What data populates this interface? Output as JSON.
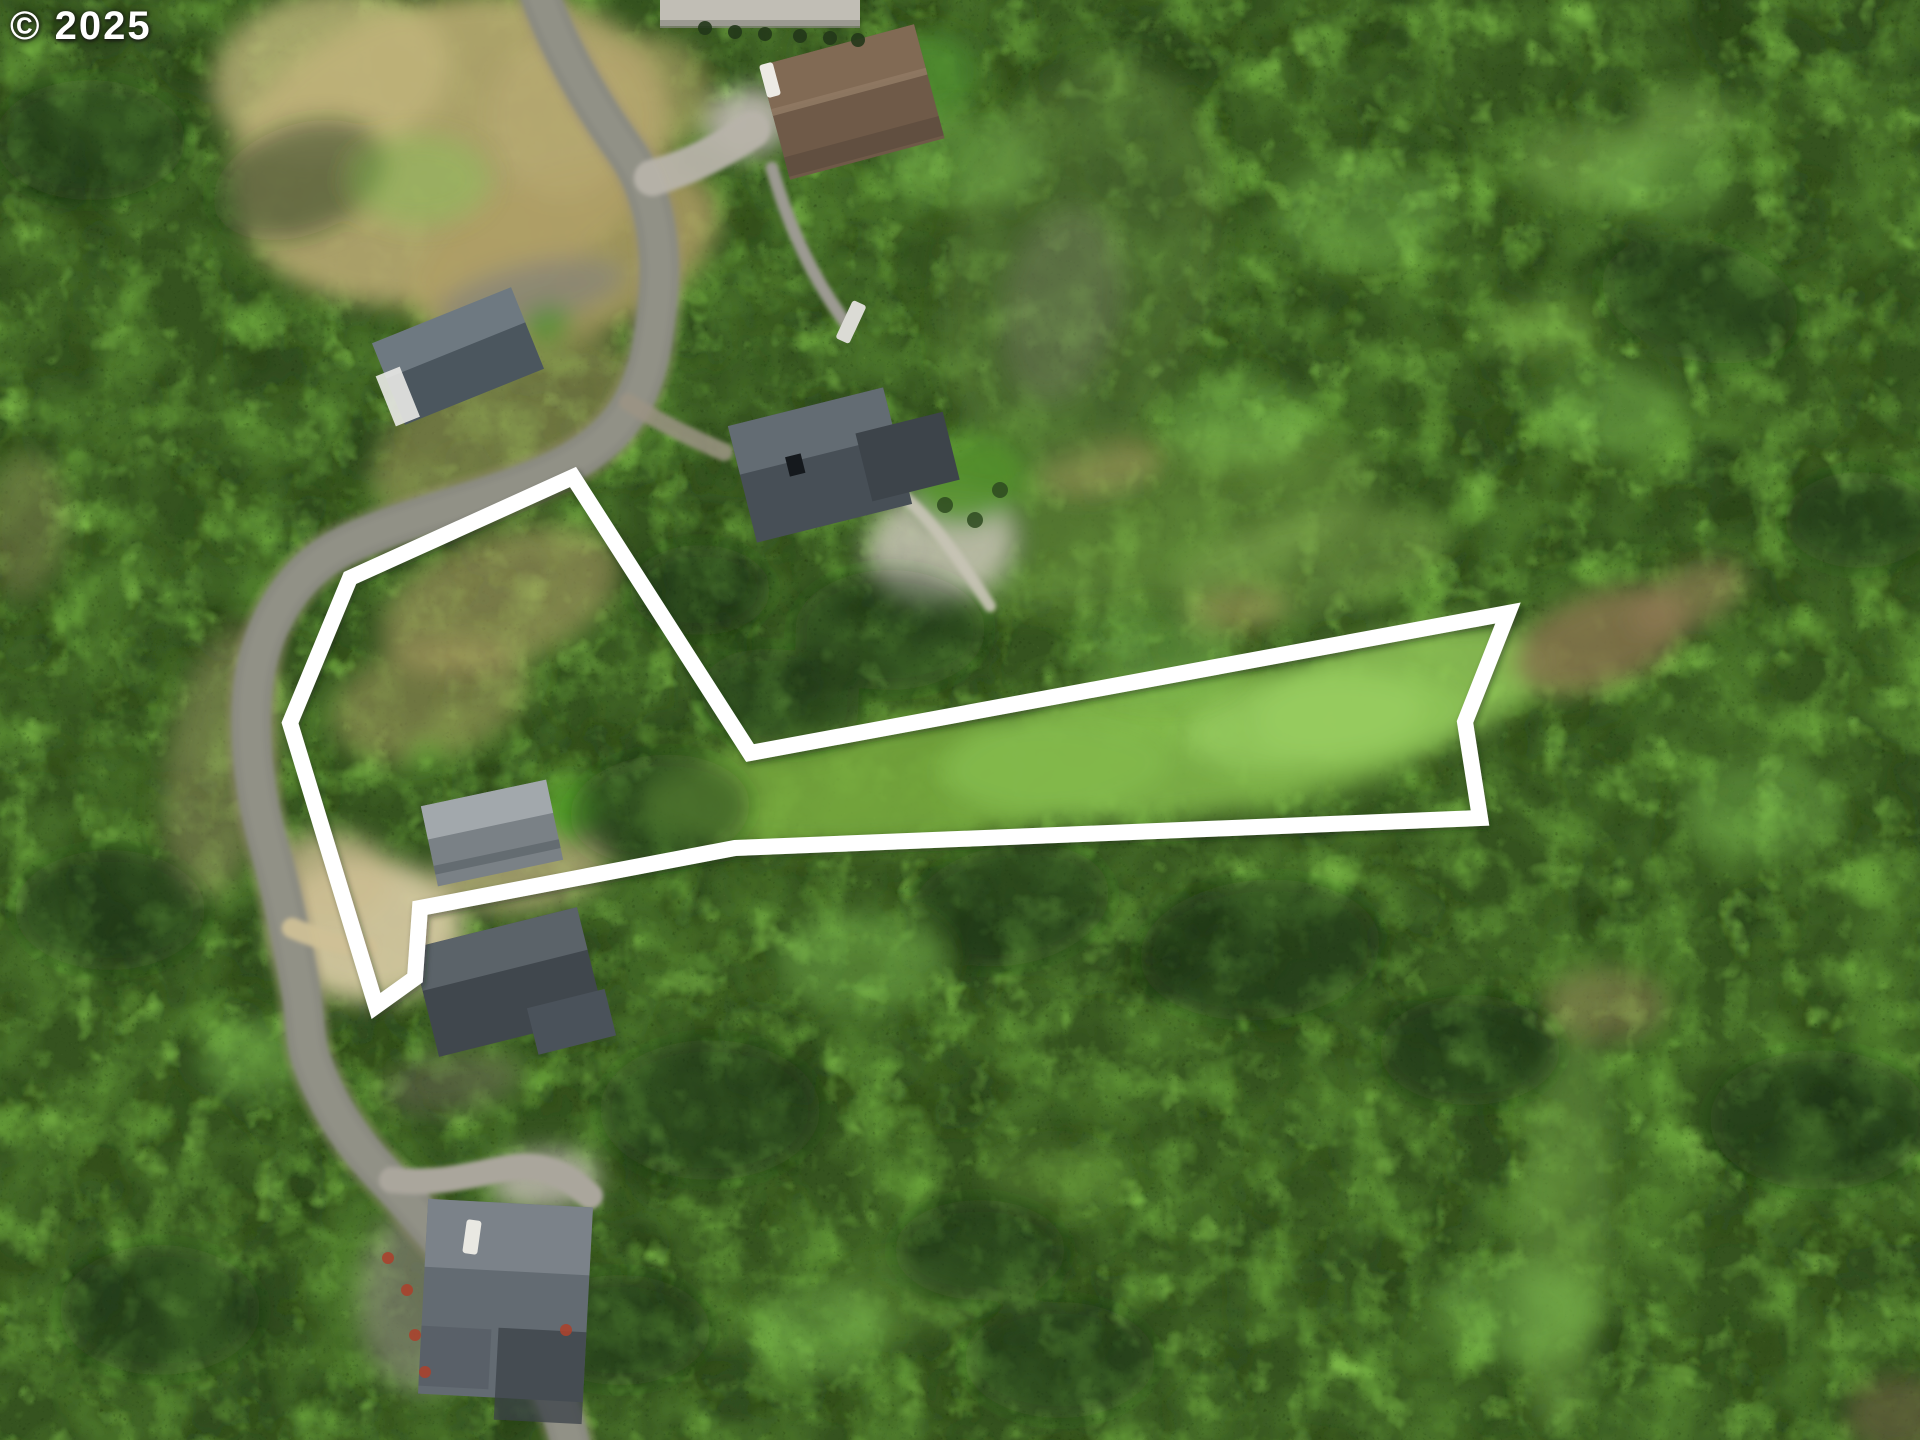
{
  "watermark": {
    "text": "© 2025",
    "color": "#ffffff"
  },
  "canvas": {
    "width": 1920,
    "height": 1440
  },
  "boundary": {
    "color": "#ffffff",
    "stroke_width": 16,
    "points": [
      [
        573,
        477
      ],
      [
        750,
        753
      ],
      [
        1508,
        613
      ],
      [
        1465,
        722
      ],
      [
        1480,
        818
      ],
      [
        735,
        848
      ],
      [
        420,
        908
      ],
      [
        415,
        978
      ],
      [
        376,
        1006
      ],
      [
        290,
        723
      ],
      [
        350,
        578
      ]
    ]
  },
  "texture_layers": [
    {
      "fill": "#35531f",
      "filter": "",
      "opacity": 1
    },
    {
      "fill": "#263f16",
      "filter": "nDark",
      "opacity": 1
    },
    {
      "fill": "#4e7a2c",
      "filter": "nMid",
      "opacity": 1
    },
    {
      "fill": "#659d38",
      "filter": "nLight",
      "opacity": 1
    },
    {
      "fill": "#7fbc49",
      "filter": "nLight2",
      "opacity": 0.9
    },
    {
      "fill": "#0d1807",
      "filter": "nSpeckD",
      "opacity": 0.32
    },
    {
      "fill": "#b4dc82",
      "filter": "nSpeckL",
      "opacity": 0.15
    }
  ],
  "patches": [
    [
      450,
      150,
      225,
      150,
      -15,
      "#b7a871",
      0.9
    ],
    [
      330,
      75,
      120,
      85,
      -10,
      "#c3b67e",
      0.75
    ],
    [
      565,
      255,
      160,
      85,
      -20,
      "#ae9e65",
      0.85
    ],
    [
      648,
      95,
      65,
      60,
      0,
      "#b3a26b",
      0.6
    ],
    [
      560,
      120,
      70,
      80,
      -10,
      "#b9aa73",
      0.6
    ],
    [
      505,
      430,
      145,
      75,
      -28,
      "#a89a62",
      0.5
    ],
    [
      500,
      600,
      125,
      65,
      -20,
      "#b2a069",
      0.55
    ],
    [
      430,
      700,
      100,
      58,
      -15,
      "#aa9961",
      0.5
    ],
    [
      368,
      930,
      95,
      72,
      0,
      "#d3c69f",
      0.95
    ],
    [
      330,
      878,
      62,
      46,
      0,
      "#cabb90",
      0.8
    ],
    [
      525,
      868,
      88,
      42,
      -10,
      "#c2b183",
      0.7
    ],
    [
      905,
      782,
      265,
      62,
      -5,
      "#79ad41",
      0.85
    ],
    [
      1205,
      742,
      265,
      72,
      -7,
      "#86bc4e",
      0.85
    ],
    [
      1400,
      692,
      150,
      62,
      -14,
      "#90c558",
      0.85
    ],
    [
      1305,
      722,
      120,
      45,
      -8,
      "#9cd065",
      0.6
    ],
    [
      1150,
      520,
      230,
      82,
      -12,
      "#6f9a44",
      0.5
    ],
    [
      1310,
      565,
      140,
      52,
      -12,
      "#7da24b",
      0.5
    ],
    [
      1100,
      468,
      62,
      26,
      -10,
      "#a5975f",
      0.55
    ],
    [
      1235,
      612,
      52,
      23,
      -10,
      "#9f8d57",
      0.5
    ],
    [
      1600,
      640,
      92,
      46,
      -20,
      "#86744e",
      0.85
    ],
    [
      1688,
      598,
      62,
      30,
      -25,
      "#907d54",
      0.65
    ],
    [
      1080,
      265,
      135,
      215,
      15,
      "#5c7a3a",
      0.45
    ],
    [
      1062,
      305,
      58,
      98,
      12,
      "#7d7f6f",
      0.35
    ],
    [
      1592,
      162,
      72,
      40,
      0,
      "#7fae4e",
      0.5
    ],
    [
      1682,
      120,
      52,
      30,
      0,
      "#88b656",
      0.45
    ],
    [
      1545,
      330,
      60,
      35,
      0,
      "#76a548",
      0.45
    ],
    [
      1565,
      1230,
      48,
      205,
      3,
      "#6f9d42",
      0.55
    ],
    [
      1605,
      1005,
      62,
      36,
      0,
      "#9b8a5c",
      0.5
    ],
    [
      905,
      1300,
      82,
      40,
      0,
      "#5d8836",
      0.4
    ],
    [
      1055,
      1180,
      72,
      36,
      0,
      "#648f3a",
      0.4
    ],
    [
      222,
      762,
      55,
      140,
      10,
      "#9f9468",
      0.45
    ],
    [
      532,
      294,
      96,
      30,
      -13,
      "#8c8775",
      0.9
    ],
    [
      940,
      545,
      75,
      58,
      -15,
      "#c6c2b4",
      0.85
    ],
    [
      968,
      480,
      60,
      45,
      -15,
      "#55922e",
      0.9
    ],
    [
      922,
      78,
      56,
      45,
      -15,
      "#4f8d2e",
      0.8
    ],
    [
      570,
      812,
      30,
      32,
      0,
      "#58a12c",
      0.95
    ],
    [
      426,
      752,
      17,
      9,
      -10,
      "#5da630",
      0.9
    ],
    [
      547,
      326,
      26,
      19,
      -20,
      "#4f8d2e",
      0.8
    ],
    [
      452,
      1082,
      70,
      30,
      -8,
      "#6b6557",
      0.5
    ],
    [
      420,
      1300,
      62,
      92,
      0,
      "#8f8b80",
      0.6
    ],
    [
      25,
      525,
      42,
      72,
      5,
      "#8d8058",
      0.4
    ],
    [
      1900,
      1415,
      55,
      40,
      0,
      "#6b5a40",
      0.6
    ],
    [
      748,
      122,
      42,
      34,
      -15,
      "#bab6ac",
      0.95
    ],
    [
      545,
      1180,
      55,
      30,
      -5,
      "#b1ada3",
      0.9
    ]
  ],
  "roads": [
    {
      "d": "M535,-20 C552,35 585,95 625,150 C655,192 663,250 658,300 C653,352 645,395 615,428 C585,461 540,480 478,499 C420,517 380,528 342,547 C300,568 268,612 256,668 C247,712 250,780 270,850 C282,892 292,940 300,985 C306,1018 304,1040 312,1062 C325,1098 345,1135 385,1177 C425,1219 468,1272 508,1320 C540,1360 560,1400 570,1442",
      "color": "#9a9074",
      "width": 52,
      "opacity": 0.3
    },
    {
      "d": "M535,-20 C552,35 585,95 625,150 C655,192 663,250 658,300 C653,352 645,395 615,428 C585,461 540,480 478,499 C420,517 380,528 342,547 C300,568 268,612 256,668 C247,712 250,780 270,850 C282,892 292,940 300,985 C306,1018 304,1040 312,1062 C325,1098 345,1135 385,1177 C425,1219 468,1272 508,1320 C540,1360 560,1400 570,1442",
      "color": "#8b8b81",
      "width": 40,
      "opacity": 1
    },
    {
      "d": "M535,-20 C552,35 585,95 625,150 C655,192 663,250 658,300 C653,352 645,395 615,428 C585,461 540,480 478,499 C420,517 380,528 342,547 C300,568 268,612 256,668 C247,712 250,780 270,850 C282,892 292,940 300,985 C306,1018 304,1040 312,1062 C325,1098 345,1135 385,1177 C425,1219 468,1272 508,1320 C540,1360 560,1400 570,1442",
      "color": "#9a998b",
      "width": 24,
      "opacity": 0.45
    },
    {
      "d": "M652,178 C688,168 720,152 752,130",
      "color": "#b7b3a9",
      "width": 36,
      "opacity": 0.95
    },
    {
      "d": "M772,168 C788,225 812,278 848,326",
      "color": "#9c9a92",
      "width": 13,
      "opacity": 1
    },
    {
      "d": "M392,1180 C450,1186 480,1170 520,1167 C550,1165 572,1180 590,1196",
      "color": "#aaa69c",
      "width": 26,
      "opacity": 1
    },
    {
      "d": "M292,928 C320,940 345,946 368,947",
      "color": "#cfc096",
      "width": 20,
      "opacity": 0.95
    },
    {
      "d": "M628,402 C662,424 692,438 724,452",
      "color": "#9b9384",
      "width": 18,
      "opacity": 0.85
    },
    {
      "d": "M880,480 C920,500 960,560 990,606",
      "color": "#c8c4b6",
      "width": 12,
      "opacity": 0.9
    }
  ],
  "houses": [
    {
      "name": "house-top-left",
      "cx": 458,
      "cy": 356,
      "rot": -22,
      "parts": [
        {
          "x": -75,
          "y": -44,
          "w": 150,
          "h": 88,
          "fill": "#4b565e",
          "op": 1
        },
        {
          "x": -75,
          "y": -44,
          "w": 150,
          "h": 38,
          "fill": "#747f87",
          "op": 0.85
        },
        {
          "x": -84,
          "y": -12,
          "w": 26,
          "h": 54,
          "fill": "#e9e9e5",
          "op": 0.9
        }
      ]
    },
    {
      "name": "house-top-center-brown",
      "cx": 852,
      "cy": 102,
      "rot": -15,
      "parts": [
        {
          "x": -80,
          "y": -59,
          "w": 160,
          "h": 118,
          "fill": "#6f5a48",
          "op": 1
        },
        {
          "x": -80,
          "y": -59,
          "w": 160,
          "h": 48,
          "fill": "#836b55",
          "op": 0.9
        },
        {
          "x": -80,
          "y": -14,
          "w": 160,
          "h": 7,
          "fill": "#8f7963",
          "op": 0.9
        },
        {
          "x": -80,
          "y": 36,
          "w": 160,
          "h": 20,
          "fill": "#5e4c3e",
          "op": 0.8
        }
      ]
    },
    {
      "name": "house-mid-right",
      "cx": 820,
      "cy": 465,
      "rot": -14,
      "parts": [
        {
          "x": -80,
          "y": -60,
          "w": 160,
          "h": 120,
          "fill": "#474f56",
          "op": 1
        },
        {
          "x": -80,
          "y": -60,
          "w": 160,
          "h": 50,
          "fill": "#6a737a",
          "op": 0.8
        },
        {
          "x": 42,
          "y": -22,
          "w": 90,
          "h": 70,
          "fill": "#3d444a",
          "op": 1
        },
        {
          "x": -32,
          "y": -16,
          "w": 16,
          "h": 20,
          "fill": "#15191d",
          "op": 1
        }
      ]
    },
    {
      "name": "house-inside-lot",
      "cx": 492,
      "cy": 833,
      "rot": -12,
      "parts": [
        {
          "x": -64,
          "y": -41,
          "w": 128,
          "h": 82,
          "fill": "#7a8186",
          "op": 1
        },
        {
          "x": -64,
          "y": -41,
          "w": 128,
          "h": 34,
          "fill": "#a6acb0",
          "op": 0.9
        },
        {
          "x": -64,
          "y": 20,
          "w": 128,
          "h": 9,
          "fill": "#5f666b",
          "op": 0.8
        }
      ]
    },
    {
      "name": "house-below-lot",
      "cx": 508,
      "cy": 982,
      "rot": -14,
      "parts": [
        {
          "x": -85,
          "y": -56,
          "w": 170,
          "h": 112,
          "fill": "#40474d",
          "op": 1
        },
        {
          "x": -85,
          "y": -56,
          "w": 170,
          "h": 44,
          "fill": "#60686f",
          "op": 0.85
        },
        {
          "x": 12,
          "y": 30,
          "w": 80,
          "h": 48,
          "fill": "#4a525a",
          "op": 1
        }
      ]
    },
    {
      "name": "house-bottom",
      "cx": 505,
      "cy": 1300,
      "rot": 3,
      "parts": [
        {
          "x": -82,
          "y": -97,
          "w": 165,
          "h": 195,
          "fill": "#636b72",
          "op": 1
        },
        {
          "x": -82,
          "y": -97,
          "w": 165,
          "h": 68,
          "fill": "#7d858c",
          "op": 0.9
        },
        {
          "x": -5,
          "y": 28,
          "w": 88,
          "h": 92,
          "fill": "#3b4248",
          "op": 0.75
        },
        {
          "x": -82,
          "y": 30,
          "w": 70,
          "h": 60,
          "fill": "#565e65",
          "op": 0.8
        }
      ]
    },
    {
      "name": "building-top-edge",
      "cx": 760,
      "cy": 12,
      "rot": 0,
      "parts": [
        {
          "x": -100,
          "y": -14,
          "w": 200,
          "h": 28,
          "fill": "#c1beb5",
          "op": 1
        },
        {
          "x": -100,
          "y": 8,
          "w": 200,
          "h": 8,
          "fill": "#8a8a82",
          "op": 0.7
        }
      ]
    }
  ],
  "details": {
    "cars": [
      {
        "x": 770,
        "y": 80,
        "rot": -15,
        "w": 14,
        "h": 34,
        "fill": "#eceae4"
      },
      {
        "x": 472,
        "y": 1237,
        "rot": 8,
        "w": 15,
        "h": 34,
        "fill": "#e9e8e2"
      },
      {
        "x": 851,
        "y": 322,
        "rot": 25,
        "w": 15,
        "h": 42,
        "fill": "#dbdbd5"
      }
    ],
    "red_shrubs": [
      [
        407,
        1290
      ],
      [
        415,
        1335
      ],
      [
        425,
        1372
      ],
      [
        566,
        1330
      ],
      [
        388,
        1258
      ]
    ],
    "red_shrub_color": "#a8432e",
    "hedges": [
      [
        705,
        28
      ],
      [
        735,
        32
      ],
      [
        765,
        34
      ],
      [
        800,
        36
      ],
      [
        830,
        38
      ],
      [
        858,
        40
      ]
    ],
    "hedge_color": "#22371a",
    "garden_bushes": [
      [
        945,
        505
      ],
      [
        975,
        520
      ],
      [
        1000,
        490
      ]
    ],
    "garden_bush_color": "#2e4a20",
    "canopy_shadows": [
      [
        300,
        180,
        90,
        55,
        -20
      ],
      [
        700,
        590,
        70,
        45,
        0
      ],
      [
        780,
        700,
        80,
        50,
        10
      ],
      [
        660,
        810,
        90,
        55,
        -5
      ],
      [
        890,
        630,
        95,
        60,
        0
      ],
      [
        1010,
        905,
        100,
        60,
        -10
      ],
      [
        1260,
        950,
        120,
        70,
        -5
      ],
      [
        710,
        1110,
        110,
        70,
        0
      ],
      [
        1700,
        300,
        100,
        60,
        15
      ],
      [
        1820,
        1120,
        110,
        70,
        0
      ],
      [
        110,
        910,
        95,
        60,
        0
      ],
      [
        160,
        1310,
        100,
        65,
        0
      ],
      [
        1860,
        520,
        75,
        48,
        0
      ],
      [
        1060,
        1360,
        95,
        58,
        0
      ],
      [
        90,
        140,
        95,
        60,
        0
      ],
      [
        1470,
        1050,
        90,
        55,
        0
      ],
      [
        620,
        1330,
        90,
        55,
        0
      ],
      [
        980,
        1250,
        85,
        50,
        0
      ]
    ],
    "canopy_shadow_color": "#1b2c12",
    "canopy_highlights": [
      [
        960,
        160,
        80,
        50
      ],
      [
        1360,
        210,
        90,
        55
      ],
      [
        1610,
        410,
        70,
        45
      ],
      [
        860,
        960,
        85,
        50
      ],
      [
        1160,
        655,
        80,
        45
      ],
      [
        255,
        1060,
        60,
        40
      ],
      [
        1760,
        810,
        80,
        50
      ],
      [
        1510,
        1310,
        80,
        50
      ],
      [
        420,
        180,
        70,
        45
      ],
      [
        1240,
        420,
        75,
        45
      ],
      [
        1660,
        180,
        70,
        42
      ],
      [
        820,
        1330,
        70,
        45
      ]
    ],
    "canopy_highlight_color": "#82c253"
  }
}
